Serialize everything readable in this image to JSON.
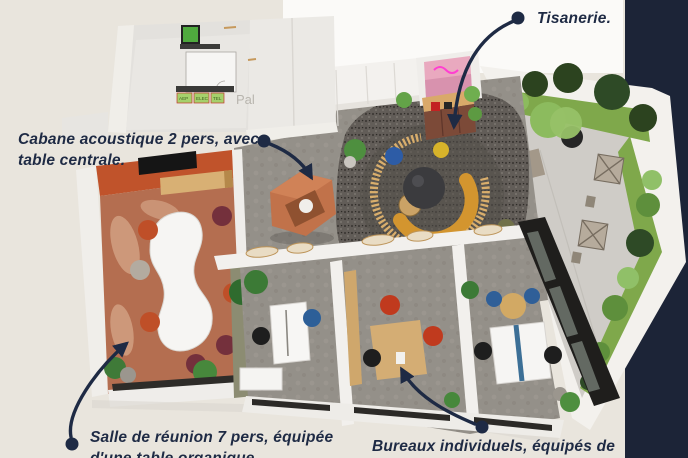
{
  "scene": {
    "description": "3D axonometric render of an office floor plan with callout annotations",
    "palier_label": "Pal",
    "meter_labels": [
      "AEP",
      "ELEC",
      "TEL"
    ]
  },
  "annotations": {
    "tisanerie": {
      "line1": "Tisanerie."
    },
    "cabane": {
      "line1": "Cabane acoustique 2 pers, avec",
      "line2": "table centrale."
    },
    "salle": {
      "line1": "Salle de réunion 7 pers, équipée",
      "line2": "d'une table organique"
    },
    "bureaux": {
      "line1": "Bureaux individuels, équipés de"
    }
  },
  "colors": {
    "page_background": "#e9e5dd",
    "render_backdrop": "#fbfaf8",
    "navy_band": "#1c2437",
    "annotation_text": "#1e2a44",
    "leader_line": "#1e2a44",
    "meeting_room_floor": "#b46e50",
    "meeting_room_wall": "#c0532b",
    "terrazzo_floor": "#625d58",
    "concrete_floor": "#949089",
    "wood": "#d2ab74",
    "booth_orange": "#c1724a",
    "neon_pink": "#ff3fd1",
    "grass": "#7fa84b",
    "glass_frame": "#1f1e1c"
  }
}
